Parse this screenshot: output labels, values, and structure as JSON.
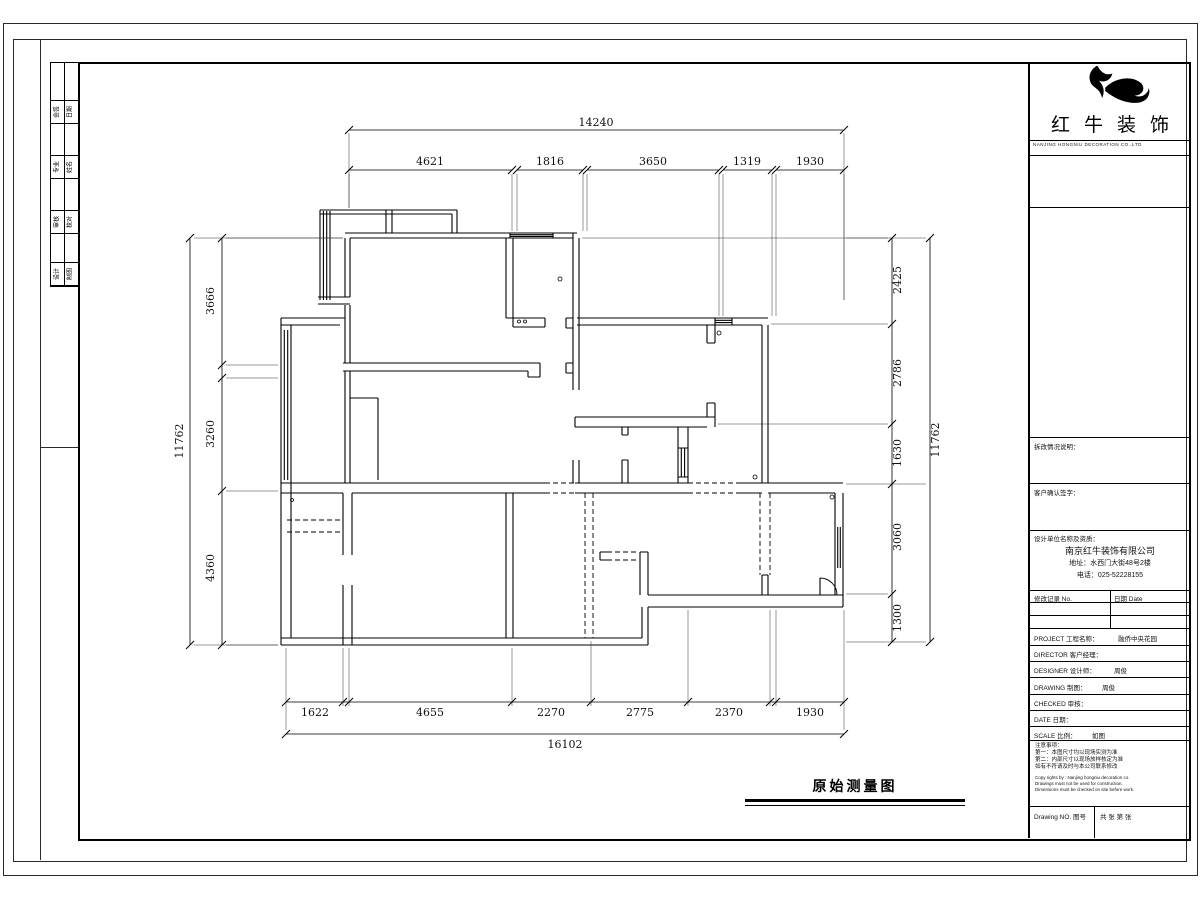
{
  "sheet": {
    "caption": "原始测量图",
    "strip_rows": [
      {
        "a": "会签",
        "b": "日期"
      },
      {
        "a": "专业",
        "b": "姓名"
      },
      {
        "a": "审核",
        "b": "校对"
      },
      {
        "a": "设计",
        "b": "制图"
      }
    ]
  },
  "dims": {
    "top_total": "14240",
    "top": [
      "4621",
      "1816",
      "3650",
      "1319",
      "1930"
    ],
    "bottom": [
      "1622",
      "4655",
      "2270",
      "2775",
      "2370",
      "1930"
    ],
    "bottom_total": "16102",
    "left": [
      "3666",
      "3260",
      "4360"
    ],
    "left_total": "11762",
    "right": [
      "2425",
      "2786",
      "1630",
      "3060",
      "1300"
    ],
    "right_total": "11762"
  },
  "titleblock": {
    "brand": "红牛装饰",
    "brand_sub": "NANJING HONGNIU DECORATION CO.,LTD",
    "sec_demolition": "拆改情况说明：",
    "sec_client": "客户确认签字：",
    "sec_company": "设计单位名称及资质：",
    "company_name": "南京红牛装饰有限公司",
    "company_addr": "地址：水西门大街48号2楼",
    "company_tel": "电话：025-52228155",
    "rev_no_label": "修改记录 No.",
    "rev_date_label": "日期 Date",
    "rows": [
      {
        "label": "PROJECT 工程名称：",
        "value": "融侨中央花园"
      },
      {
        "label": "DIRECTOR 客户经理：",
        "value": ""
      },
      {
        "label": "DESIGNER 设计师：",
        "value": "周俊"
      },
      {
        "label": "DRAWING 制图：",
        "value": "周俊"
      },
      {
        "label": "CHECKED 审核：",
        "value": ""
      },
      {
        "label": "DATE 日期：",
        "value": ""
      },
      {
        "label": "SCALE 比例：",
        "value": "如图"
      }
    ],
    "notes_title": "注意事项：",
    "notes_cn": [
      "第一：本图尺寸均以现场实测为准",
      "第二：内部尺寸以现场放样核定为准",
      "如有不符请及时与本公司联系修改"
    ],
    "notes_en": [
      "Copy rights by : Nanjing hongniu decoration co.",
      "Drawings must not be used for construction.",
      "Dimensions must be checked on site before work."
    ],
    "drawing_no_label": "Drawing NO. 图号",
    "sheet_label": "共 张 第 张"
  }
}
